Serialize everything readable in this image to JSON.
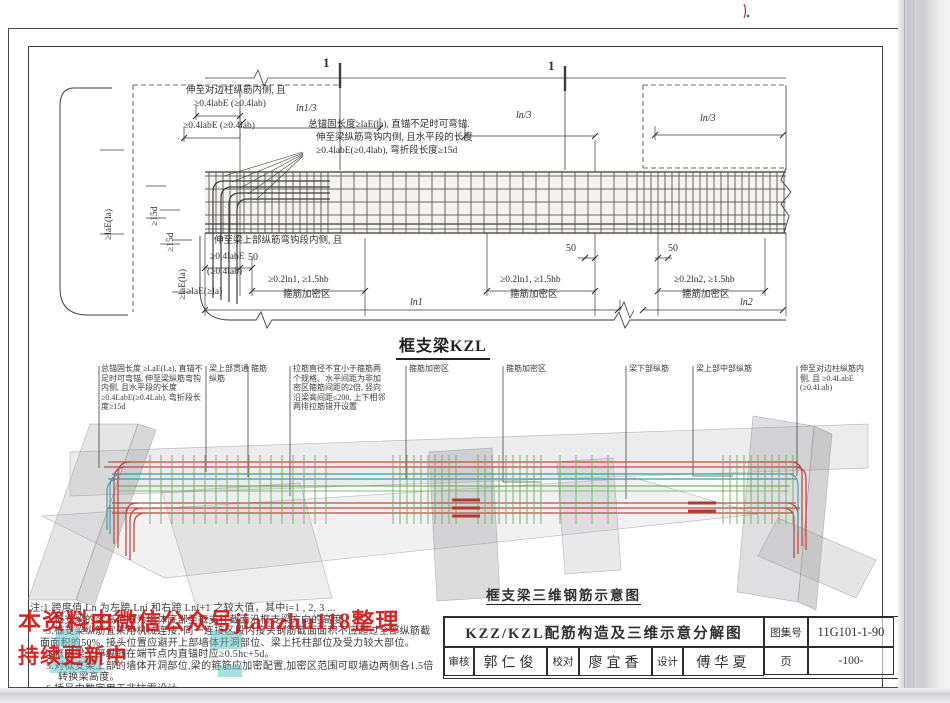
{
  "header": {
    "drawing_title": "框支梁KZL",
    "iso_caption": "框支梁三维钢筋示意图",
    "section_marker": "1"
  },
  "dim_labels": {
    "reach_far_col": "伸至对边柱纵筋内侧, 且",
    "ge04_pair": "≥0.4labE (≥0.4lab)",
    "anchor_note_1": "总锚固长度≥laE(la), 直锚不足时可弯锚.",
    "anchor_note_2": "伸至梁纵筋弯钩内侧, 且水平段的长度",
    "anchor_note_3": "≥0.4labE(≥0.4lab), 弯折段长度≥15d",
    "ln1_over_3": "ln1/3",
    "ln_over_3": "ln/3",
    "ge_lae": "≥laE(la)",
    "ge_15d": "≥15d",
    "reach_beam_top": "伸至梁上部纵筋弯钩段内侧, 且",
    "ge04_labe": "≥0.4labE",
    "ge04_lab": "(≥0.4lab)",
    "fifty": "50",
    "ge_lae_ge_la": "≥laE(≥la)",
    "dense1": "≥0.2ln1, ≥1.5hb",
    "dense2": "≥0.2ln2, ≥1.5hb",
    "dense_zone": "箍筋加密区",
    "ln1": "ln1",
    "ln2": "ln2"
  },
  "callouts": {
    "c1": "总锚固长度 ≥LaE(La), 直锚不足时可弯锚, 伸至梁纵筋弯钩内侧, 且水平段的长度 ≥0.4LabE(≥0.4Lab), 弯折段长度≥15d",
    "c2": "梁上部贯通纵筋",
    "c3": "箍筋",
    "c4": "拉筋直径不宜小于箍筋两个规格、水平间距为非加密区箍筋间距的2倍, 竖向沿梁高间距≤200, 上下相邻两排拉筋错开设置",
    "c5": "箍筋加密区",
    "c7": "梁下部纵筋",
    "c8": "梁上部中部纵筋",
    "c9": "伸至对边柱纵筋内侧, 且 ≥0.4LabE (≥0.4Lab)"
  },
  "notes": {
    "l1": "注:1.跨度值 Ln 为左跨 Lni 和右跨 Lni+1 之较大值，其中i=1 , 2, 3 ...",
    "l2": "2.框支梁的梁高范围为墙体底部至框支柱截面沿框支梁方向的高度。",
    "l3": "3.框支梁纵筋宜采用机械连接, 同一连接区段内接头钢筋截面面积不应超过全部纵筋截",
    "l4": "面面积的50%, 接头位置应避开上部墙体开洞部位、梁上托柱部位及受力较大部位。",
    "l5": "4.框支梁上部纵筋在端节点内直锚时应≥0.5hc+5d。",
    "l6": "5.对框支梁上部的墙体开洞部位,梁的箍筋应加密配置,加密区范围可取墙边两侧各1.5倍",
    "l7": "转换梁高度。",
    "l8": "6.括号内数字用于非抗震设计。"
  },
  "watermark": {
    "line1": "本资料由微信公众号jianzhu118整理",
    "line2": "持续更新中"
  },
  "title_block": {
    "title": "KZZ/KZL配筋构造及三维示意分解图",
    "atlas_label": "图集号",
    "atlas_no": "11G101-1-90",
    "review_label": "审核",
    "reviewer": "郭仁俊",
    "check_label": "校对",
    "checker": "廖宜香",
    "design_label": "设计",
    "designer": "傅华夏",
    "page_label": "页",
    "page_no": "-100-"
  },
  "colors": {
    "rebar_red": "#bf4a45",
    "rebar_teal": "#3e96a8",
    "stirrup_green": "#6aae59",
    "watermark_red": "#cf1616",
    "concrete_gray": "#a8a8ac"
  }
}
